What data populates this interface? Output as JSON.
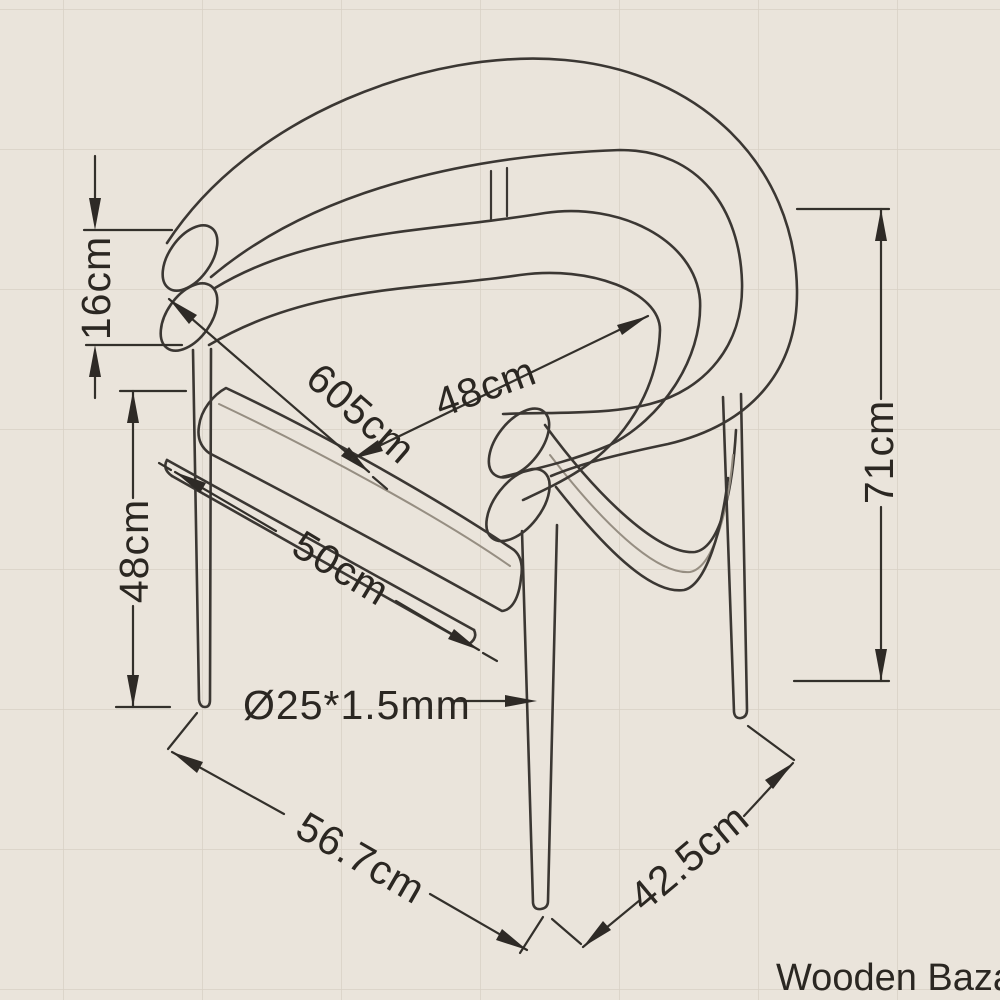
{
  "drawing": {
    "kind": "chair technical dimension drawing",
    "colors": {
      "paper": "#eae4db",
      "grid": "#d8d0c5",
      "ink": "#2e2a26"
    },
    "labels": {
      "back_tube_height": "16cm",
      "seat_height": "48cm",
      "overall_height": "71cm",
      "back_outer_width": "605cm",
      "back_inner_width": "48cm",
      "seat_depth": "50cm",
      "tube_spec": "Ø25*1.5mm",
      "base_depth": "56.7cm",
      "base_width": "42.5cm"
    },
    "watermark": "Wooden Bazar"
  }
}
